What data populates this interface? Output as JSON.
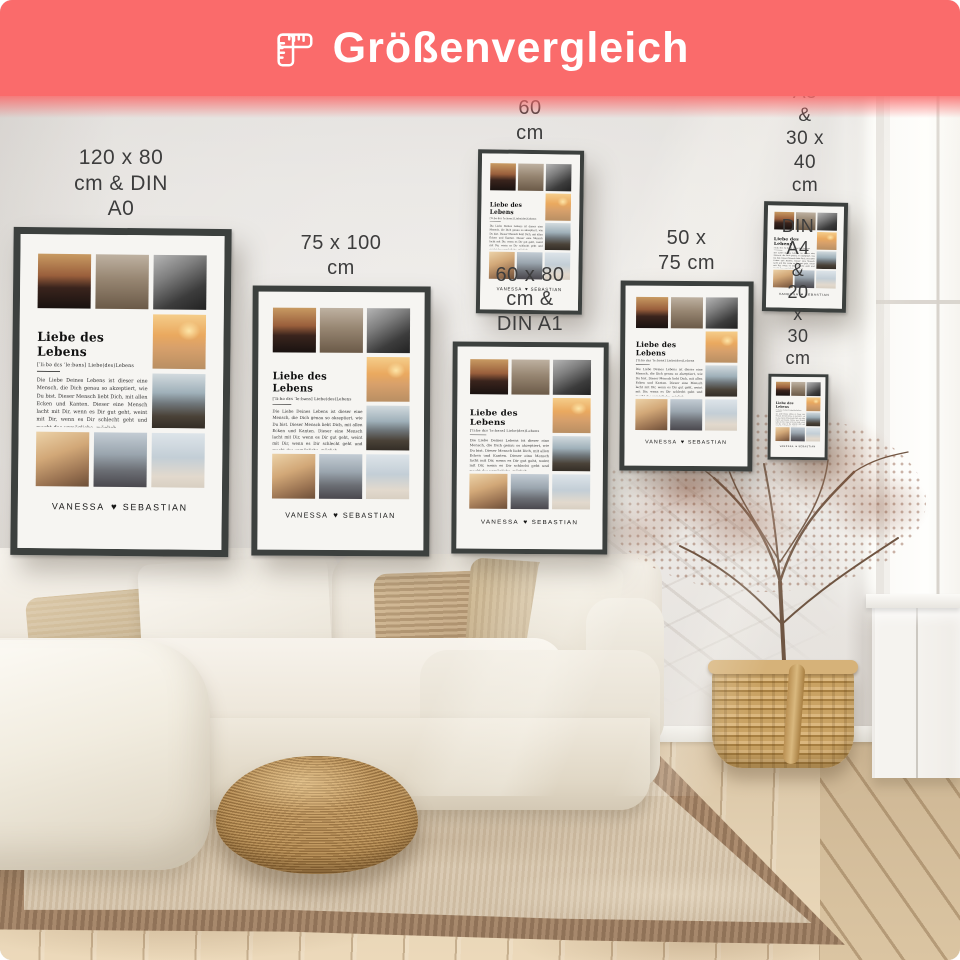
{
  "header": {
    "title": "Größenvergleich",
    "banner_color": "#fa6b6b",
    "title_color": "#ffffff",
    "icon": "folding-ruler-icon"
  },
  "wall": {
    "label_color": "#3d3d3d",
    "posters": [
      {
        "label": "120 x 80 cm & DIN A0"
      },
      {
        "label": "75 x 100 cm"
      },
      {
        "label": "DIN A2 &\n40 x 60 cm"
      },
      {
        "label": "60 x 80 cm & DIN A1"
      },
      {
        "label": "50 x 75 cm"
      },
      {
        "label": "DIN A3 &\n30 x 40 cm"
      },
      {
        "label": "DIN A4 &\n20 x 30 cm"
      }
    ]
  },
  "poster_design": {
    "title": "Liebe des Lebens",
    "phonetic": "[ˈliːbə dɛs ˈleːbəns]   Liebe(des)Lebens",
    "definition": "Die Liebe Deines Lebens ist dieser eine Mensch, die Dich genau so akzeptiert, wie Du bist. Dieser Mensch liebt Dich, mit allen Ecken und Kanten. Dieser eine Mensch lacht mit Dir, wenn es Dir gut geht, weint mit Dir, wenn es Dir schlecht geht und macht das unmögliche, möglich.",
    "names_left": "VANESSA",
    "heart": "♥",
    "names_right": "SEBASTIAN",
    "frame_color": "#3c403e",
    "paper_color": "#f6f5f2",
    "photos": [
      {
        "name": "photo-couple-sunset-silhouette",
        "gradient": "linear-gradient(180deg,#c89a62 0%,#9a5f3c 40%,#3a241d 62%,#191210 100%)"
      },
      {
        "name": "photo-couple-walking-mountains",
        "gradient": "linear-gradient(180deg,#beb1a1 0%,#978672 45%,#6b5a48 100%)"
      },
      {
        "name": "photo-couple-closeup-bw",
        "gradient": "linear-gradient(150deg,#b5b5b5 0%,#7e7e7e 35%,#3c3c3c 70%,#222222 100%)"
      },
      {
        "name": "photo-couple-beach-sunset",
        "gradient": "radial-gradient(30% 25% at 68% 30%,rgba(255,235,175,.9),transparent 70%),linear-gradient(180deg,#f5cd8a 0%,#eaa95f 38%,#d7a06b 62%,#b98f63 100%)"
      },
      {
        "name": "photo-couple-lake-view",
        "gradient": "linear-gradient(180deg,#d2dade 0%,#9fb0b9 35%,#6f767a 55%,#4a4238 78%,#332d26 100%)"
      },
      {
        "name": "photo-couple-beach-daylight",
        "gradient": "linear-gradient(160deg,#ecd2a8 0%,#d2a878 40%,#9a7352 75%,#6d4f38 100%)"
      },
      {
        "name": "photo-couple-embrace-dusk",
        "gradient": "linear-gradient(180deg,#c3ccd4 0%,#9aa5ae 40%,#6b6e74 70%,#4a484e 100%)"
      },
      {
        "name": "photo-couple-face-to-face",
        "gradient": "linear-gradient(180deg,#dde4e9 0%,#c3ced6 45%,#e2d9cd 80%,#d8cfc2 100%)"
      }
    ]
  },
  "scene": {
    "wall_color": "#e7e4e0",
    "sofa_color": "#f2eee5",
    "rug_color": "#d8c8b0",
    "rug_border_color": "#a8896a",
    "floor_color": "#e0cdad",
    "pouf_color": "#b0884f",
    "basket_color": "#c5a065",
    "plant_color": "#9c6249"
  }
}
